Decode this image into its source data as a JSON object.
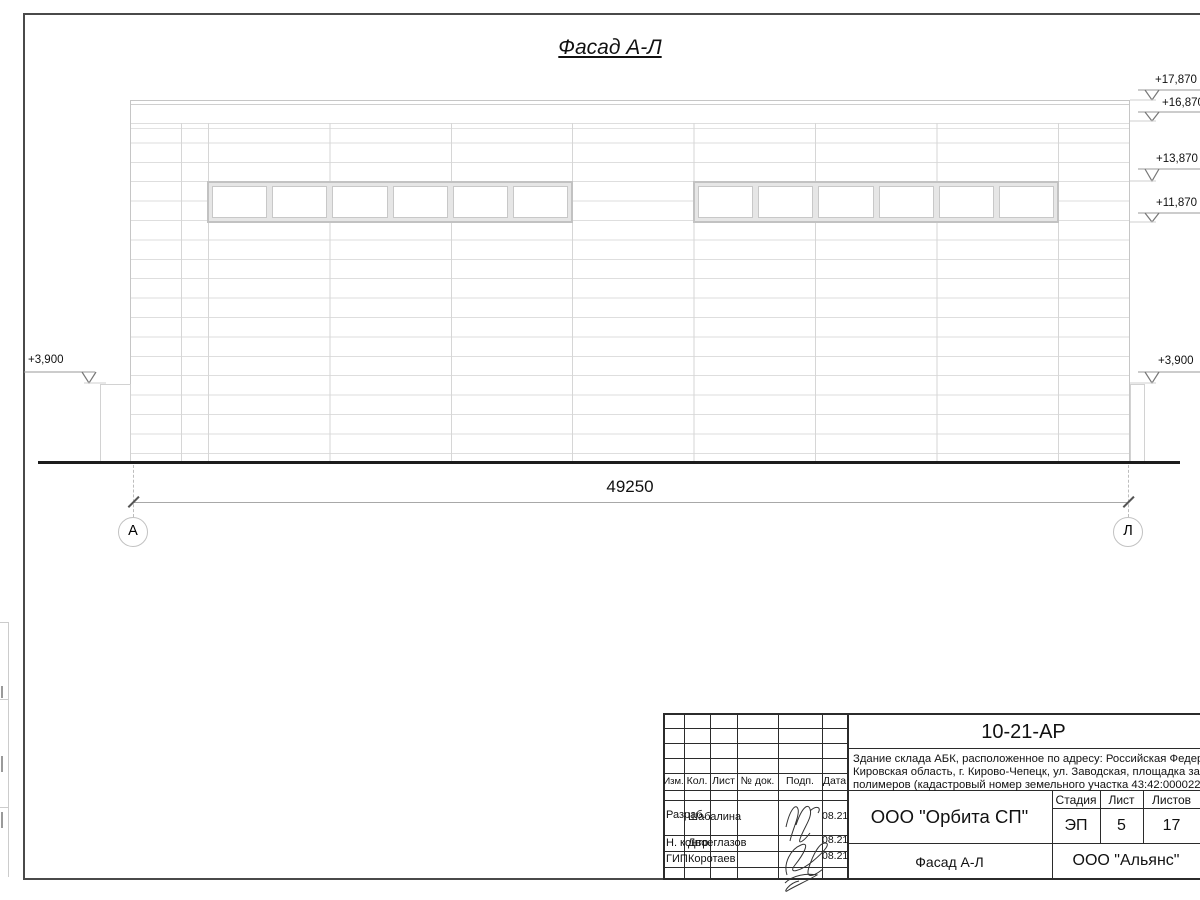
{
  "facade": {
    "title": "Фасад А-Л",
    "overall_dimension": "49250",
    "axes": {
      "left": "А",
      "right": "Л"
    },
    "elevations": {
      "left": "+3,900",
      "right": [
        "+17,870",
        "+16,870",
        "+13,870",
        "+11,870",
        "+3,900"
      ]
    }
  },
  "title_block": {
    "doc_number": "10-21-АР",
    "description": {
      "line1": "Здание склада АБК, расположенное по адресу: Российская Федерация,",
      "line2": "Кировская область, г. Кирово-Чепецк, ул. Заводская, площадка завода",
      "line3": "полимеров (кадастровый номер земельного участка 43:42:000022:"
    },
    "rev_header": {
      "izm": "Изм.",
      "kol": "Кол.",
      "list": "Лист",
      "doc": "№ док.",
      "podp": "Подп.",
      "data": "Дата"
    },
    "rows": [
      {
        "role": "Разраб.",
        "name": "Шабалина",
        "date": "08.21"
      },
      {
        "role": "Н. контр.",
        "name": "Двоеглазов",
        "date": "08.21"
      },
      {
        "role": "ГИП",
        "name": "Коротаев",
        "date": "08.21"
      }
    ],
    "company": "ООО \"Орбита СП\"",
    "stage": {
      "label": "Стадия",
      "value": "ЭП"
    },
    "sheet": {
      "label": "Лист",
      "value": "5"
    },
    "sheets": {
      "label": "Листов",
      "value": "17"
    },
    "drawing_name": "Фасад А-Л",
    "contractor": "ООО \"Альянс\""
  }
}
